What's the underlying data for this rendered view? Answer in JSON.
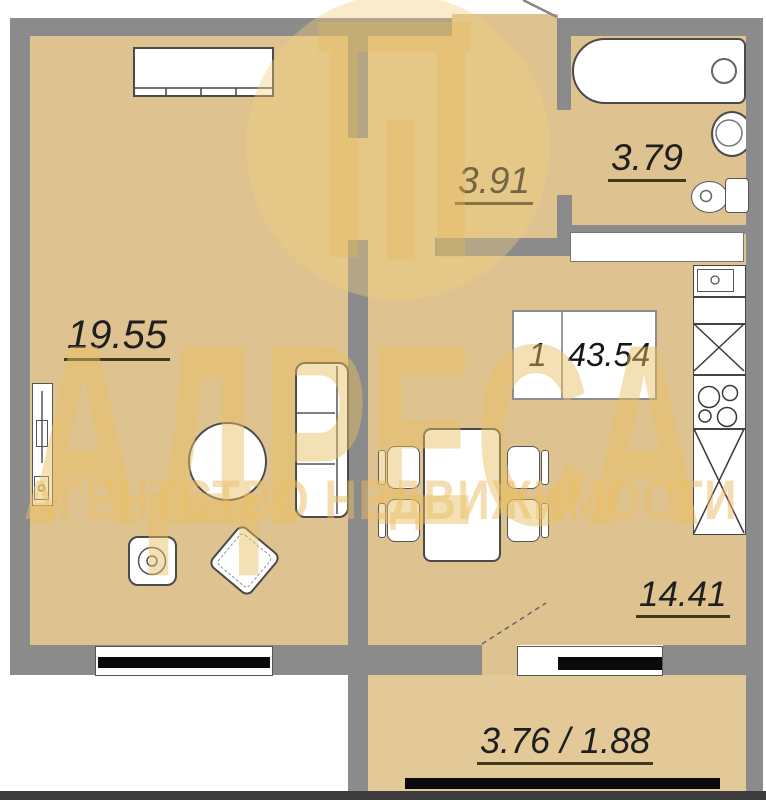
{
  "floorplan": {
    "rooms": {
      "living": {
        "name": "living-room",
        "area": "19.55"
      },
      "hallway": {
        "name": "hallway",
        "area": "3.91"
      },
      "bathroom": {
        "name": "bathroom",
        "area": "3.79"
      },
      "kitchen": {
        "name": "kitchen",
        "area": "14.41"
      },
      "balcony": {
        "name": "balcony",
        "area": "3.76 / 1.88"
      }
    },
    "summary": {
      "rooms_count": "1",
      "total_area": "43.54"
    },
    "fixtures": [
      "wardrobe",
      "tv-unit",
      "round-table",
      "sofa",
      "armchair",
      "side-table",
      "dining-table",
      "chairs",
      "bathtub",
      "sink",
      "toilet",
      "stove-hob",
      "kitchen-cabinets",
      "windows",
      "balcony-rail",
      "entrance-door",
      "balcony-door"
    ]
  },
  "watermark": {
    "title": "АДРЕСА",
    "subtitle": "АГЕНТСТВО НЕДВИЖИМОСТИ"
  },
  "colors": {
    "floor": "#dec390",
    "balcony_floor": "#e3c998",
    "wall": "#8b8b8b",
    "window_glass": "#0a0a0a",
    "watermark_yellow": "#eac46e",
    "label_text": "#1f1f1f"
  }
}
